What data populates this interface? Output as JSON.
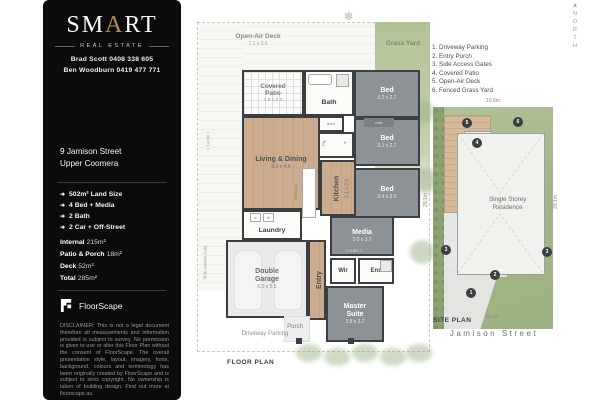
{
  "brand": {
    "name_pre": "SM",
    "name_accent": "A",
    "name_post": "RT",
    "tagline": "REAL ESTATE"
  },
  "agents": {
    "agent1": "Brad Scott 0408 338 605",
    "agent2": "Ben Woodburn 0419 477 771"
  },
  "listing": {
    "address_line1": "9 Jamison Street",
    "address_line2": "Upper Coomera",
    "features": [
      "502m² Land Size",
      "4 Bed + Media",
      "2 Bath",
      "2 Car + Off-Street"
    ],
    "areas": [
      {
        "label": "Internal",
        "value": "215m²"
      },
      {
        "label": "Patio & Porch",
        "value": "18m²"
      },
      {
        "label": "Deck",
        "value": "52m²"
      },
      {
        "label": "Total",
        "value": "285m²"
      }
    ]
  },
  "branding_footer": {
    "provider": "FloorScape",
    "disclaimer": "DISCLAIMER: This is not a legal document therefore all measurements and information provided is subject to survey. No permission is given to use or alter this Floor Plan without the consent of FloorScape. The overall presentation style, layout, imagery, fonts, background, colours and terminology has been originally created by FloorScape and is subject to strict copyright. No ownership is taken of building design. Find out more at floorscape.au."
  },
  "icons": {
    "feature_arrow": "➔",
    "flower": "✽",
    "north_arrow": "➤"
  },
  "floor_plan": {
    "title": "FLOOR PLAN",
    "dim_side": "< 14.0m >",
    "dim_width": "< 6.5m >",
    "side_gate": "Side Access Gate",
    "outdoor": {
      "deck_name": "Open-Air Deck",
      "deck_dim": "7.1 x 3.6",
      "grass": "Grass Yard",
      "driveway": "Driveway Parking",
      "porch": "Porch"
    },
    "rooms": {
      "covered_patio": {
        "name": "Covered Patio",
        "dim": "4.6 x 2.2"
      },
      "bath": {
        "name": "Bath"
      },
      "bed1": {
        "name": "Bed",
        "dim": "3.2 x 2.7"
      },
      "bed2": {
        "name": "Bed",
        "dim": "3.1 x 2.7"
      },
      "bed3": {
        "name": "Bed",
        "dim": "3.4 x 3.0"
      },
      "living": {
        "name": "Living & Dining",
        "dim": "8.0 x 4.6"
      },
      "kitchen": {
        "name": "Kitchen",
        "dim": "3.1 x 2.6"
      },
      "media": {
        "name": "Media",
        "dim": "3.0 x 3.7"
      },
      "laundry": {
        "name": "Laundry"
      },
      "garage": {
        "name": "Double Garage",
        "dim": "6.0 x 5.5"
      },
      "entry": {
        "name": "Entry"
      },
      "wir": {
        "name": "Wir"
      },
      "ens": {
        "name": "Ens"
      },
      "master": {
        "name": "Master Suite",
        "dim": "3.8 x 3.7"
      }
    },
    "fixtures": {
      "linen": "linen",
      "robe": "robe",
      "pantry": "Pty",
      "fridge": "fr",
      "dining_bar": "dining bar",
      "washer": "w",
      "dryer": "dr"
    }
  },
  "legend": {
    "items": [
      "1. Driveway Parking",
      "2. Entry Porch",
      "3. Side Access Gates",
      "4. Covered Patio",
      "5. Open-Air Deck",
      "6. Fenced Grass Yard"
    ]
  },
  "site_plan": {
    "title": "SITE PLAN",
    "residence": "Single Storey Residence",
    "street": "Jamison Street",
    "north": "NORTH",
    "dim_top": "16.8m",
    "dim_bottom": "16.8m",
    "dim_left": "29.1m",
    "dim_right": "29.1m",
    "markers": {
      "m1": "1",
      "m2": "2",
      "m3a": "3",
      "m3b": "3",
      "m4": "4",
      "m5": "5",
      "m6": "6"
    }
  }
}
